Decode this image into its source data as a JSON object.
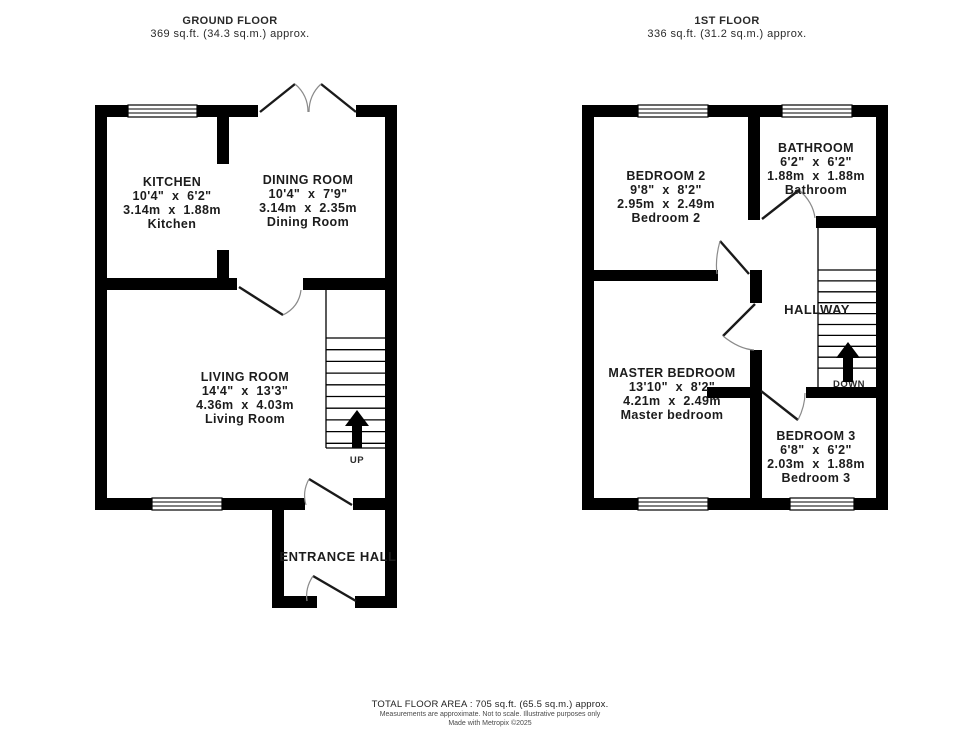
{
  "ground_floor": {
    "title": "GROUND FLOOR",
    "area": "369 sq.ft. (34.3 sq.m.) approx.",
    "rooms": {
      "kitchen": {
        "name": "KITCHEN",
        "dim_ft": "10'4\"  x  6'2\"",
        "dim_m": "3.14m  x  1.88m",
        "alt": "Kitchen"
      },
      "dining": {
        "name": "DINING ROOM",
        "dim_ft": "10'4\"  x  7'9\"",
        "dim_m": "3.14m  x  2.35m",
        "alt": "Dining Room"
      },
      "living": {
        "name": "LIVING ROOM",
        "dim_ft": "14'4\"  x  13'3\"",
        "dim_m": "4.36m  x  4.03m",
        "alt": "Living Room"
      }
    },
    "entrance_hall": "ENTRANCE HALL",
    "stairs_label": "UP"
  },
  "first_floor": {
    "title": "1ST FLOOR",
    "area": "336 sq.ft. (31.2 sq.m.) approx.",
    "rooms": {
      "bedroom2": {
        "name": "BEDROOM 2",
        "dim_ft": "9'8\"  x  8'2\"",
        "dim_m": "2.95m  x  2.49m",
        "alt": "Bedroom 2"
      },
      "bathroom": {
        "name": "BATHROOM",
        "dim_ft": "6'2\"  x  6'2\"",
        "dim_m": "1.88m  x  1.88m",
        "alt": "Bathroom"
      },
      "master": {
        "name": "MASTER BEDROOM",
        "dim_ft": "13'10\"  x  8'2\"",
        "dim_m": "4.21m  x  2.49m",
        "alt": "Master bedroom"
      },
      "bedroom3": {
        "name": "BEDROOM 3",
        "dim_ft": "6'8\"  x  6'2\"",
        "dim_m": "2.03m  x  1.88m",
        "alt": "Bedroom 3"
      }
    },
    "hallway": "HALLWAY",
    "stairs_label": "DOWN"
  },
  "footer": {
    "total": "TOTAL FLOOR AREA : 705 sq.ft. (65.5 sq.m.) approx.",
    "disclaimer": "Measurements are approximate.  Not to scale.  Illustrative purposes only",
    "credit": "Made with Metropix ©2025"
  },
  "icons": {
    "stairs_up_arrow": "↑",
    "stairs_down_arrow": "↑"
  },
  "colors": {
    "wall": "#000000",
    "text": "#1c1c1c",
    "door_arc": "#8a8a8a",
    "background": "#ffffff"
  }
}
